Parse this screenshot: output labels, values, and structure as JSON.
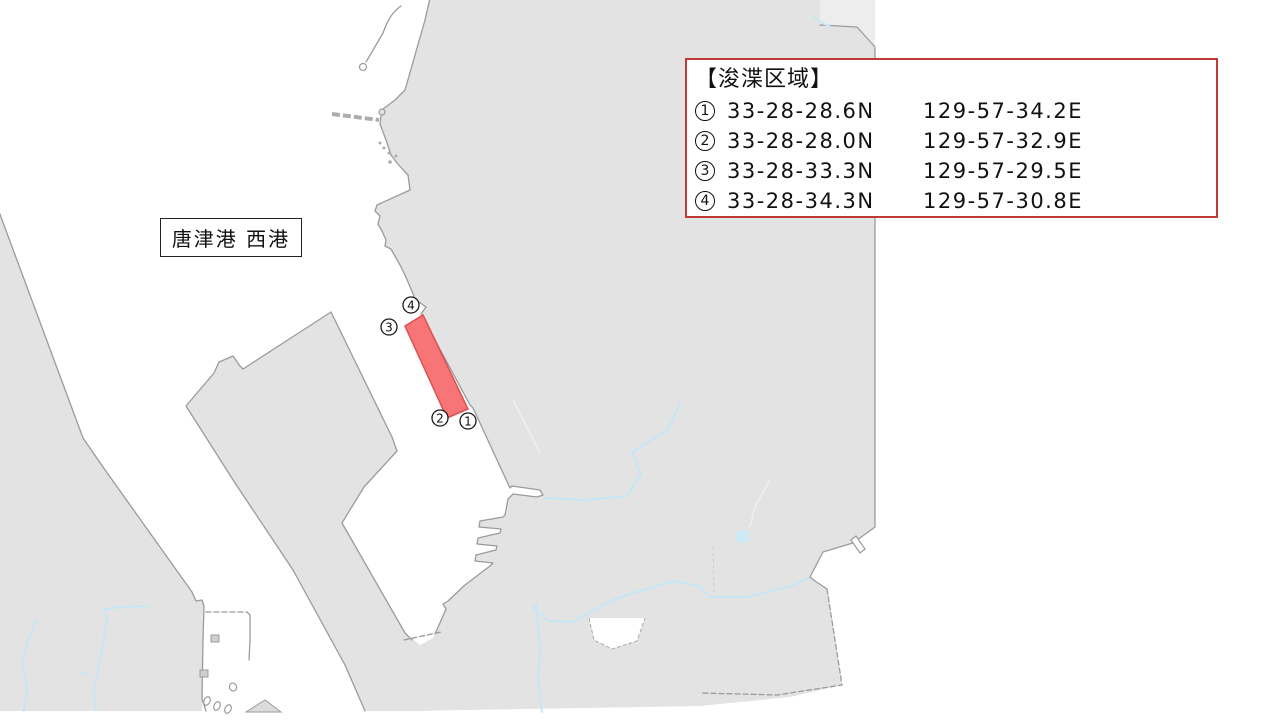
{
  "colors": {
    "water": "#FFFFFF",
    "land": "#E3E3E3",
    "coast": "#9B9B9B",
    "stream": "#C5E7F5",
    "dredge_fill": "#F87577",
    "dredge_border": "#DD5052",
    "legend_border": "#C03A36"
  },
  "port_label": {
    "text": "唐津港 西港"
  },
  "legend": {
    "title": "【浚渫区域】",
    "entries": [
      {
        "num": "1",
        "lat": "33-28-28.6N",
        "lon": "129-57-34.2E"
      },
      {
        "num": "2",
        "lat": "33-28-28.0N",
        "lon": "129-57-32.9E"
      },
      {
        "num": "3",
        "lat": "33-28-33.3N",
        "lon": "129-57-29.5E"
      },
      {
        "num": "4",
        "lat": "33-28-34.3N",
        "lon": "129-57-30.8E"
      }
    ]
  },
  "map": {
    "width": 1280,
    "height": 720,
    "markers": [
      {
        "num": "4",
        "x": 411,
        "y": 305
      },
      {
        "num": "3",
        "x": 389,
        "y": 327
      },
      {
        "num": "2",
        "x": 440,
        "y": 418
      },
      {
        "num": "1",
        "x": 468,
        "y": 421
      }
    ],
    "shapes": [
      {
        "name": "east-land",
        "type": "polygon",
        "cls": "land",
        "points": [
          430,
          -2,
          425,
          20,
          405,
          90,
          395,
          100,
          383,
          109,
          381,
          116,
          380,
          124,
          386,
          140,
          391,
          155,
          397,
          163,
          405,
          172,
          408,
          175,
          410,
          190,
          377,
          205,
          375,
          211,
          380,
          216,
          378,
          224,
          382,
          231,
          386,
          240,
          385,
          246,
          391,
          249,
          400,
          265,
          405,
          275,
          414,
          296,
          409,
          301,
          419,
          302,
          426,
          307,
          421,
          314,
          470,
          405,
          473,
          408,
          510,
          488,
          512,
          486,
          540,
          490,
          543,
          495,
          537,
          497,
          513,
          494,
          508,
          499,
          505,
          515,
          503,
          517,
          480,
          521,
          479,
          527,
          501,
          529,
          500,
          533,
          478,
          538,
          477,
          544,
          497,
          546,
          496,
          550,
          476,
          555,
          475,
          561,
          493,
          563,
          490,
          566,
          465,
          585,
          448,
          601,
          443,
          604,
          446,
          609,
          439,
          625,
          433,
          638,
          415,
          648,
          408,
          711,
          700,
          706,
          790,
          697,
          842,
          685,
          828,
          590,
          815,
          581,
          810,
          577,
          823,
          552,
          853,
          543,
          875,
          527,
          875,
          48,
          857,
          27,
          820,
          25,
          820,
          -2
        ]
      },
      {
        "name": "top-right-parcel",
        "type": "polygon",
        "cls": "land-light",
        "points": [
          820,
          -2,
          875,
          -2,
          875,
          46,
          857,
          26,
          820,
          25
        ]
      },
      {
        "name": "top-right-parcel-edge",
        "type": "polyline",
        "cls": "coast",
        "points": [
          820,
          25,
          857,
          27,
          875,
          47
        ]
      },
      {
        "name": "wedge-pier",
        "type": "polygon",
        "cls": "land",
        "points": [
          331,
          312,
          392,
          437,
          397,
          451,
          364,
          487,
          342,
          523,
          405,
          633,
          420,
          645,
          430,
          711,
          365,
          711,
          345,
          665,
          293,
          570,
          235,
          483,
          186,
          406,
          214,
          373,
          219,
          362,
          233,
          356,
          240,
          366,
          243,
          369
        ]
      },
      {
        "name": "wedge-pier-coast",
        "type": "polyline",
        "cls": "coast",
        "points": [
          365,
          711,
          345,
          665,
          293,
          570,
          235,
          483,
          186,
          406,
          214,
          373,
          219,
          362,
          233,
          356,
          240,
          366,
          243,
          369,
          331,
          312,
          392,
          437,
          397,
          451,
          364,
          487,
          342,
          523,
          405,
          633,
          412,
          640
        ]
      },
      {
        "name": "east-coastline",
        "type": "polyline",
        "cls": "coast",
        "points": [
          430,
          -2,
          425,
          20,
          405,
          90,
          395,
          100,
          383,
          109,
          381,
          116,
          380,
          124,
          386,
          140,
          391,
          155,
          397,
          163,
          405,
          172,
          408,
          175,
          410,
          190,
          377,
          205,
          375,
          211,
          380,
          216,
          378,
          224,
          382,
          231,
          386,
          240,
          385,
          246,
          391,
          249,
          400,
          265,
          405,
          275,
          414,
          296,
          409,
          301,
          419,
          302,
          426,
          307,
          421,
          314,
          470,
          405,
          473,
          408,
          510,
          488,
          512,
          486,
          540,
          490,
          543,
          495,
          537,
          497,
          513,
          494,
          508,
          499,
          505,
          515,
          503,
          517,
          480,
          521,
          479,
          527,
          501,
          529,
          500,
          533,
          478,
          538,
          477,
          544,
          497,
          546,
          496,
          550,
          476,
          555,
          475,
          561,
          493,
          563,
          490,
          566,
          465,
          585,
          448,
          601,
          443,
          604,
          446,
          609,
          439,
          625,
          435,
          634
        ]
      },
      {
        "name": "channel-end-dashed-edge",
        "type": "polyline",
        "cls": "coast-dash",
        "points": [
          404,
          640,
          441,
          632
        ]
      },
      {
        "name": "southeast-coastline",
        "type": "polyline",
        "cls": "coast",
        "points": [
          875,
          48,
          875,
          527,
          853,
          543,
          823,
          552,
          810,
          577,
          815,
          581,
          827,
          589
        ]
      },
      {
        "name": "boundary-dashed-line",
        "type": "polyline",
        "cls": "coast-dash",
        "points": [
          827,
          589,
          842,
          685,
          777,
          695,
          700,
          693
        ]
      },
      {
        "name": "west-land",
        "type": "polygon",
        "cls": "land",
        "points": [
          -2,
          209,
          83,
          438,
          103,
          467,
          192,
          592,
          196,
          601,
          202,
          600,
          204,
          606,
          203,
          611,
          202,
          711,
          -2,
          711
        ]
      },
      {
        "name": "west-coastline",
        "type": "polyline",
        "cls": "coast",
        "points": [
          -2,
          209,
          83,
          438,
          103,
          467,
          192,
          592,
          196,
          601,
          202,
          600,
          204,
          606,
          203,
          640,
          202,
          699,
          206,
          711
        ]
      },
      {
        "name": "dock-top-dashed-pier",
        "type": "polyline",
        "cls": "coast-dash",
        "points": [
          206,
          612,
          247,
          612
        ]
      },
      {
        "name": "dock-right-wall",
        "type": "polyline",
        "cls": "coast",
        "points": [
          247,
          612,
          250,
          615,
          250,
          640,
          249,
          660
        ]
      },
      {
        "name": "dock-structure-1",
        "type": "rect",
        "cls": "structure-gray",
        "attrs": {
          "x": 211,
          "y": 635,
          "width": 8,
          "height": 7
        }
      },
      {
        "name": "dock-structure-2",
        "type": "rect",
        "cls": "structure-gray",
        "attrs": {
          "x": 200,
          "y": 670,
          "width": 8,
          "height": 7
        }
      },
      {
        "name": "moored-boat-1",
        "type": "ellipse",
        "cls": "structure",
        "attrs": {
          "cx": 207,
          "cy": 701,
          "rx": 3,
          "ry": 4.5,
          "transform": "rotate(25 207 701)"
        }
      },
      {
        "name": "moored-boat-2",
        "type": "ellipse",
        "cls": "structure",
        "attrs": {
          "cx": 217,
          "cy": 706,
          "rx": 3,
          "ry": 4.5,
          "transform": "rotate(25 217 706)"
        }
      },
      {
        "name": "moored-boat-3",
        "type": "ellipse",
        "cls": "structure",
        "attrs": {
          "cx": 228,
          "cy": 709,
          "rx": 3,
          "ry": 4.5,
          "transform": "rotate(25 228 709)"
        }
      },
      {
        "name": "moored-boat-4",
        "type": "ellipse",
        "cls": "structure",
        "attrs": {
          "cx": 233,
          "cy": 687,
          "rx": 3.5,
          "ry": 4,
          "transform": "rotate(-20 233 687)"
        }
      },
      {
        "name": "basin-islet",
        "type": "polygon",
        "cls": "islet",
        "points": [
          246,
          712,
          265,
          700,
          281,
          712
        ]
      },
      {
        "name": "inland-white-patch",
        "type": "polygon",
        "cls": "white-patch",
        "points": [
          589,
          618,
          594,
          640,
          612,
          649,
          637,
          641,
          645,
          618
        ]
      },
      {
        "name": "inland-white-patch-edge",
        "type": "polyline",
        "cls": "patch-edge",
        "points": [
          589,
          618,
          594,
          640,
          612,
          649,
          637,
          641,
          645,
          618
        ]
      },
      {
        "name": "breakwater",
        "type": "polyline",
        "cls": "breakwater",
        "points": [
          332,
          114,
          379,
          120
        ]
      },
      {
        "name": "breakwater-knob",
        "type": "circle",
        "cls": "knob",
        "attrs": {
          "cx": 382,
          "cy": 112,
          "r": 3
        }
      },
      {
        "name": "channel-marker-line",
        "type": "path",
        "cls": "coast",
        "attrs": {
          "d": "M 401,6 C 391,13 387,22 383,33 L 366,62"
        }
      },
      {
        "name": "channel-marker-buoy",
        "type": "circle",
        "cls": "structure",
        "attrs": {
          "cx": 363,
          "cy": 67,
          "r": 3.5
        }
      },
      {
        "name": "islet-dot-1",
        "type": "circle",
        "cls": "dot",
        "attrs": {
          "cx": 380,
          "cy": 143,
          "r": 1.5
        }
      },
      {
        "name": "islet-dot-2",
        "type": "circle",
        "cls": "dot",
        "attrs": {
          "cx": 384,
          "cy": 148,
          "r": 1.5
        }
      },
      {
        "name": "islet-dot-3",
        "type": "circle",
        "cls": "dot",
        "attrs": {
          "cx": 389,
          "cy": 153,
          "r": 1.5
        }
      },
      {
        "name": "islet-dot-4",
        "type": "circle",
        "cls": "dot",
        "attrs": {
          "cx": 390,
          "cy": 162,
          "r": 1.8
        }
      },
      {
        "name": "islet-dot-5",
        "type": "circle",
        "cls": "dot",
        "attrs": {
          "cx": 396,
          "cy": 156,
          "r": 1.5
        }
      },
      {
        "name": "small-pier-southeast",
        "type": "polygon",
        "cls": "structure",
        "points": [
          851,
          540,
          856,
          536,
          865,
          549,
          860,
          553
        ]
      },
      {
        "name": "stream-1",
        "type": "polyline",
        "cls": "stream",
        "points": [
          680,
          403,
          668,
          430,
          632,
          452,
          641,
          474,
          627,
          496,
          585,
          500,
          546,
          498
        ]
      },
      {
        "name": "stream-2",
        "type": "polyline",
        "cls": "stream",
        "points": [
          808,
          578,
          795,
          585,
          747,
          597,
          709,
          597,
          700,
          586,
          673,
          581,
          640,
          591,
          612,
          600,
          573,
          622,
          549,
          621,
          533,
          607
        ]
      },
      {
        "name": "stream-3",
        "type": "polyline",
        "cls": "stream",
        "points": [
          147,
          606,
          122,
          607,
          104,
          609,
          107,
          618,
          102,
          652,
          97,
          673,
          94,
          695,
          96,
          710
        ]
      },
      {
        "name": "stream-4",
        "type": "polyline",
        "cls": "stream",
        "points": [
          36,
          620,
          28,
          641,
          22,
          660,
          27,
          690,
          24,
          711
        ]
      },
      {
        "name": "stream-4b",
        "type": "polyline",
        "cls": "stream",
        "points": [
          78,
          672,
          86,
          674
        ]
      },
      {
        "name": "stream-5",
        "type": "polyline",
        "cls": "stream",
        "points": [
          536,
          604,
          540,
          650,
          538,
          680,
          542,
          712
        ]
      },
      {
        "name": "stream-top-corner",
        "type": "polyline",
        "cls": "stream",
        "points": [
          814,
          17,
          822,
          23,
          831,
          27
        ]
      },
      {
        "name": "pond",
        "type": "rect",
        "cls": "pond",
        "attrs": {
          "x": 735,
          "y": 531,
          "width": 14,
          "height": 11,
          "rx": 2
        }
      },
      {
        "name": "faint-road-1",
        "type": "polyline",
        "cls": "road",
        "points": [
          513,
          400,
          540,
          453
        ]
      },
      {
        "name": "faint-road-2",
        "type": "polyline",
        "cls": "road",
        "points": [
          770,
          480,
          755,
          507,
          750,
          527
        ]
      },
      {
        "name": "faint-boundary",
        "type": "polyline",
        "cls": "faintdash",
        "points": [
          713,
          547,
          714,
          593
        ]
      },
      {
        "name": "dredging-area",
        "type": "polygon",
        "cls": "dredge",
        "points": [
          405,
          326,
          423,
          315,
          468,
          409,
          447,
          418
        ]
      }
    ]
  }
}
